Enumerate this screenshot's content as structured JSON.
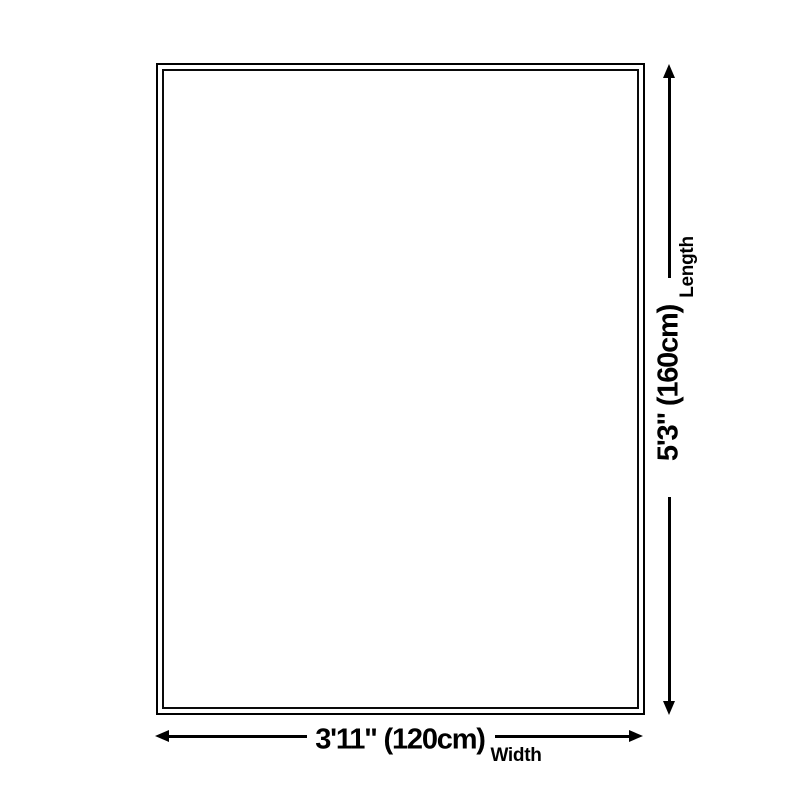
{
  "diagram": {
    "type": "product-dimension-diagram",
    "background_color": "#ffffff",
    "line_color": "#000000",
    "shape_fill": "#ffffff",
    "length": {
      "label": "Length",
      "value": "5'3\" (160cm)"
    },
    "width": {
      "label": "Width",
      "value": "3'11\" (120cm)"
    }
  }
}
